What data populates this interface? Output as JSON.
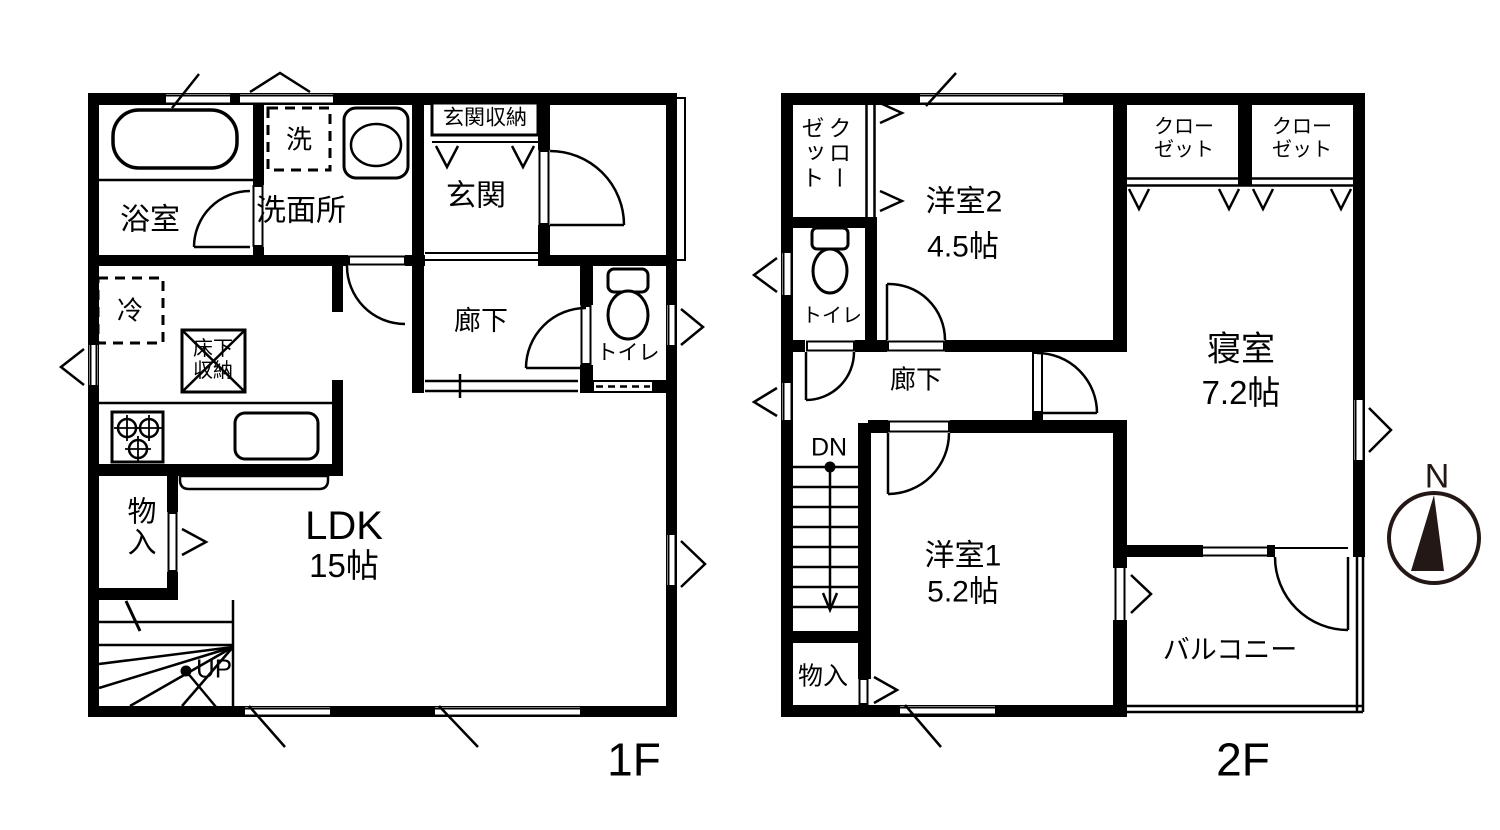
{
  "colors": {
    "line": "#000000",
    "background": "#ffffff",
    "compass": "#231815"
  },
  "floor1": {
    "floor_label": "1F",
    "bath": "浴室",
    "washer": "洗",
    "washroom": "洗面所",
    "entrance_storage": "玄関収納",
    "entrance": "玄関",
    "hallway": "廊下",
    "toilet": "トイレ",
    "fridge": "冷",
    "underfloor_storage_line1": "床下",
    "underfloor_storage_line2": "収納",
    "ldk": "LDK",
    "ldk_size": "15帖",
    "storage": "物入",
    "stairs_up": "UP"
  },
  "floor2": {
    "floor_label": "2F",
    "closet": "クローゼット",
    "closet_line1": "クロー",
    "closet_line2": "ゼット",
    "western_room2": "洋室2",
    "western_room2_size": "4.5帖",
    "bedroom": "寝室",
    "bedroom_size": "7.2帖",
    "toilet": "トイレ",
    "hallway": "廊下",
    "stairs_down": "DN",
    "western_room1": "洋室1",
    "western_room1_size": "5.2帖",
    "storage": "物入",
    "balcony": "バルコニー"
  },
  "compass": {
    "north": "N"
  }
}
